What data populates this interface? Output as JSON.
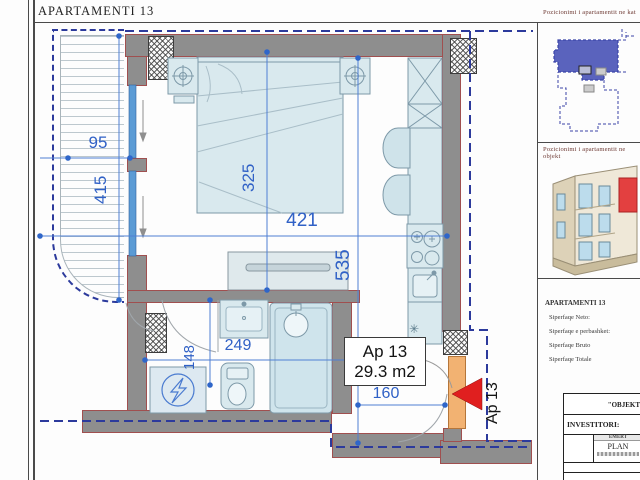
{
  "title": "APARTAMENTI 13",
  "sidebar": {
    "caption_floor": "Pozicionimi i apartamentit ne kat",
    "caption_building": "Pozicionimi i apartamentit ne objekt",
    "info_title": "APARTAMENTI 13",
    "info_rows": [
      "Siperfaqe Neto:",
      "Siperfaqe e perbashket:",
      "Siperfaqe Bruto",
      "Siperfaqe Totale"
    ],
    "titleblock": {
      "object_row": "\"OBJEKT",
      "investor_row": "INVESTITORI:",
      "name_cell_top": "EMERT",
      "name_cell_main": "PLAN"
    }
  },
  "plan": {
    "unit_label_line1": "Ap 13",
    "unit_label_line2": "29.3 m2",
    "entrance_label": "Ap 13",
    "boiler_symbol": "✳",
    "dims": {
      "balcony_w": "95",
      "balcony_h": "415",
      "bed_len": "325",
      "room_w": "421",
      "room_h": "535",
      "bath_h": "148",
      "bath_w": "249",
      "entry_w": "160"
    }
  },
  "colors": {
    "dim_blue": "#3061c6",
    "boundary_navy": "#2c3a9c",
    "wall_gray": "#8e8e8e",
    "wall_outline": "#a04f4f",
    "fixture_fill": "#d9e9ee",
    "fixture_stroke": "#7d99a8",
    "door_orange": "#f2b272",
    "entrance_red": "#e01f1f",
    "keyplan_highlight": "#5a63bd",
    "building_red": "#e34040"
  }
}
